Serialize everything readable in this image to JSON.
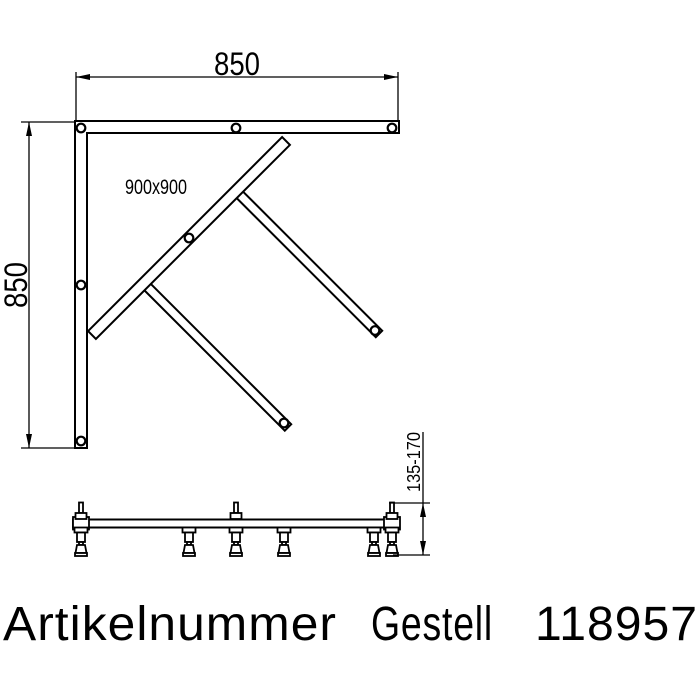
{
  "page": {
    "background": "#ffffff",
    "line_color": "#000000"
  },
  "plan_view": {
    "width_dimension": "850",
    "height_dimension": "850",
    "size_label": "900x900"
  },
  "side_view": {
    "height_range": "135-170"
  },
  "caption": {
    "label": "Artikelnummer",
    "product": "Gestell",
    "article_number": "118957"
  }
}
